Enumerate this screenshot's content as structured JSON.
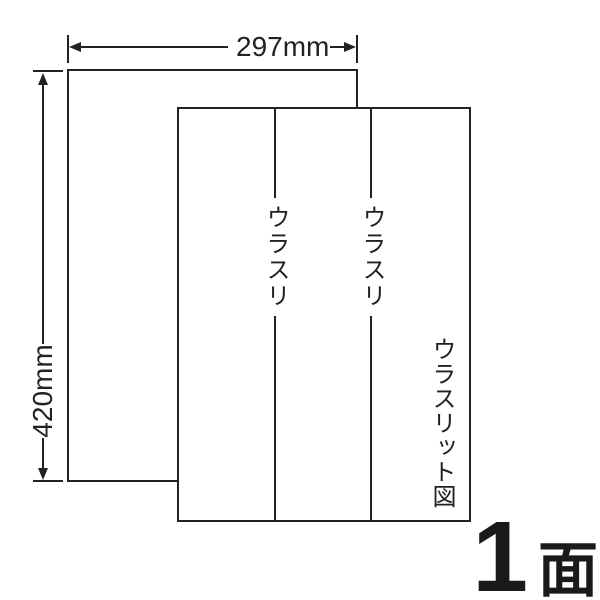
{
  "figure": {
    "kind": "label-sheet-back-slit-diagram",
    "background": "#ffffff",
    "line_color": "#222222"
  },
  "dimensions": {
    "width_label": "297mm",
    "height_label": "420mm"
  },
  "sheet": {
    "slit_labels": [
      "ウラスリ",
      "ウラスリ"
    ],
    "title": "ウラスリット図"
  },
  "count": {
    "number": "1",
    "unit": "面"
  }
}
